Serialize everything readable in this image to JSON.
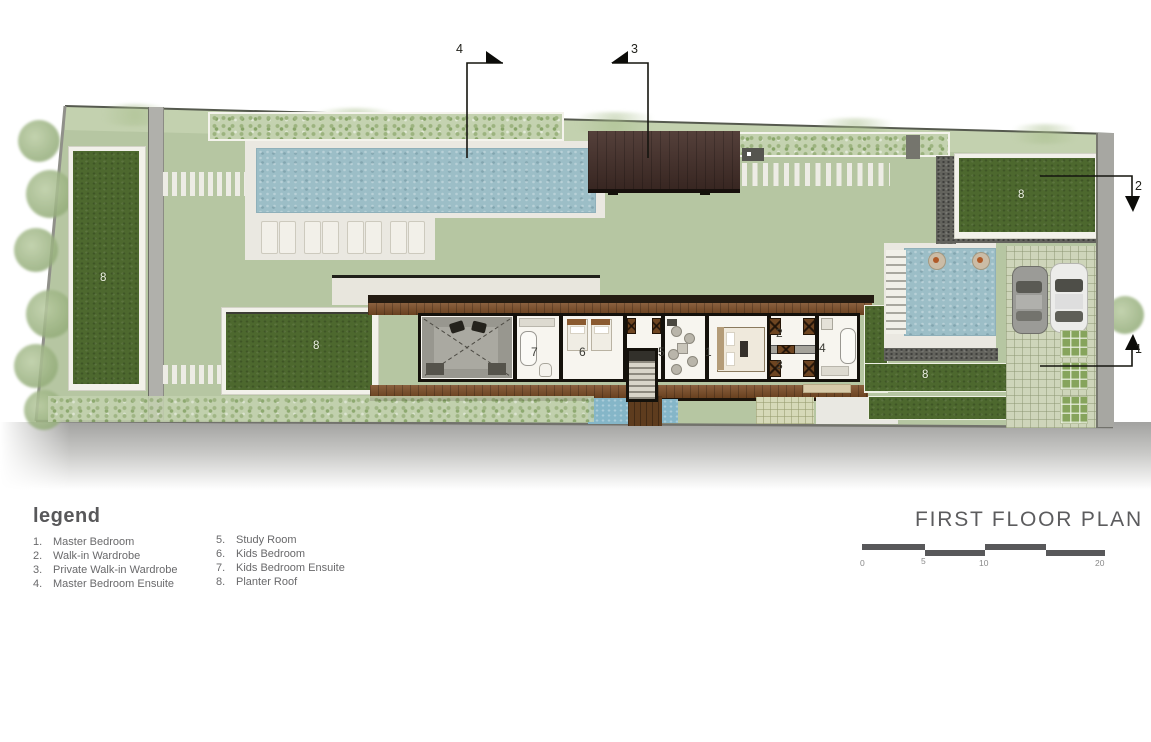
{
  "legend": {
    "heading": "legend",
    "items": [
      {
        "num": "1.",
        "label": "Master Bedroom"
      },
      {
        "num": "2.",
        "label": "Walk-in Wardrobe"
      },
      {
        "num": "3.",
        "label": "Private Walk-in Wardrobe"
      },
      {
        "num": "4.",
        "label": "Master Bedroom Ensuite"
      },
      {
        "num": "5.",
        "label": "Study Room"
      },
      {
        "num": "6.",
        "label": "Kids Bedroom"
      },
      {
        "num": "7.",
        "label": "Kids Bedroom Ensuite"
      },
      {
        "num": "8.",
        "label": "Planter Roof"
      }
    ]
  },
  "title": {
    "text": "FIRST FLOOR PLAN"
  },
  "scale": {
    "labels": [
      "0",
      "5",
      "10",
      "20"
    ]
  },
  "sections": {
    "s1": "1",
    "s2": "2",
    "s3": "3",
    "s4": "4"
  },
  "rooms": {
    "master_bedroom": "1",
    "walk_in_wardrobe": "2",
    "private_wardrobe": "3",
    "master_ensuite": "4",
    "study_room": "5",
    "kids_bedroom": "6",
    "kids_ensuite": "7"
  },
  "planter": {
    "label": "8"
  },
  "colors": {
    "lawn": "#b6c6a2",
    "planter_green": "#4d682e",
    "pool_blue": "#9cbec7",
    "pavilion_roof": "#46302a",
    "deck_wood": "#7a4b24",
    "text_gray": "#5c5c5e"
  }
}
